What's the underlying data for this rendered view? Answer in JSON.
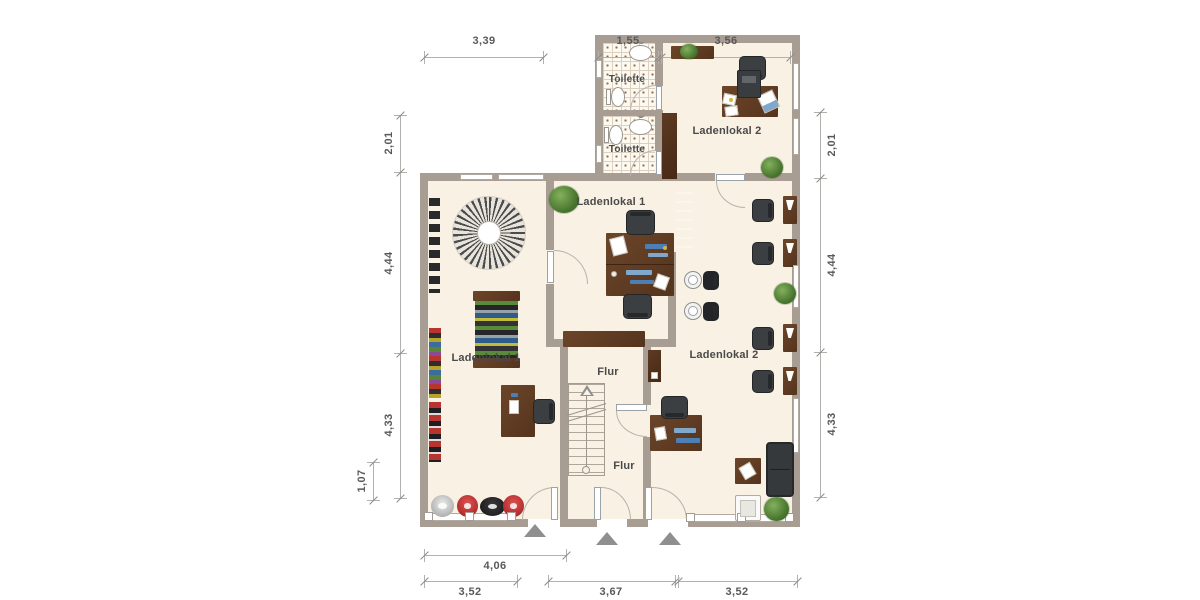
{
  "title": "Grundriss Erdgeschoss – Ladenlokale",
  "colors": {
    "wall": "#a89d93",
    "floor": "#f8f1e4",
    "wood_furniture": "#5d3a22",
    "seating": "#3c3f42",
    "plant": "#4a7730",
    "dimension_text": "#595959",
    "room_label_text": "#4a4a4a",
    "entrance_arrow": "#8f8f8f"
  },
  "rooms": [
    {
      "id": "toilette-upper",
      "label": "Toilette"
    },
    {
      "id": "toilette-lower",
      "label": "Toilette"
    },
    {
      "id": "ladenlokal-2-upper",
      "label": "Ladenlokal 2"
    },
    {
      "id": "ladenlokal-1-inner",
      "label": "Ladenlokal 1"
    },
    {
      "id": "ladenlokal-1-main",
      "label": "Ladenlokal 1"
    },
    {
      "id": "flur-upper",
      "label": "Flur"
    },
    {
      "id": "flur-lower",
      "label": "Flur"
    },
    {
      "id": "ladenlokal-2-main",
      "label": "Ladenlokal 2"
    }
  ],
  "dimensions": {
    "top": [
      "3,39",
      "1,55",
      "3,56"
    ],
    "left_outer": [
      "2,01",
      "4,44",
      "4,33"
    ],
    "left_inner": "1,07",
    "right": [
      "2,01",
      "4,44",
      "4,33"
    ],
    "bottom_inner": "4,06",
    "bottom_outer": [
      "3,52",
      "3,67",
      "3,52"
    ]
  }
}
